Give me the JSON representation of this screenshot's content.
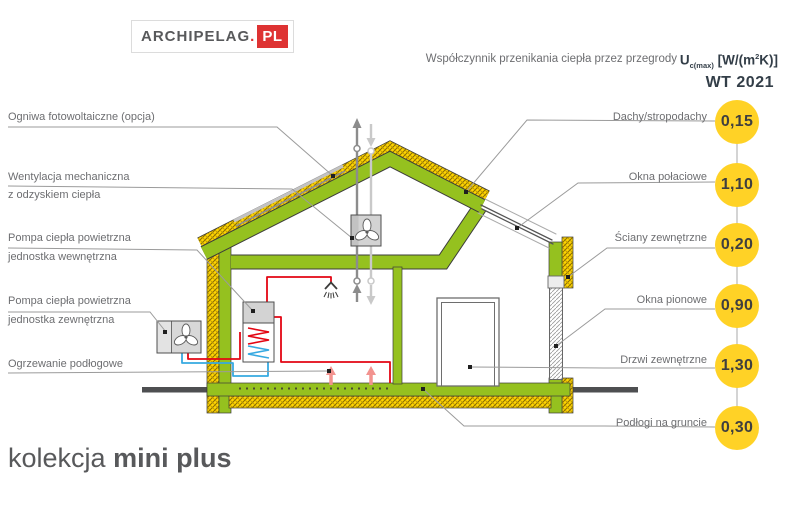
{
  "logo": {
    "brand": "ARCHIPELAG",
    "separator": ".",
    "country": "PL"
  },
  "header": {
    "title": "Współczynnik przenikania ciepła przez przegrody",
    "u_symbol": "U",
    "u_subscript": "c(max)",
    "u_units_open": " [W/(m",
    "u_units_exp": "2",
    "u_units_close": "K)]",
    "standard": "WT 2021"
  },
  "left_labels": [
    {
      "line1": "Ogniwa fotowoltaiczne (opcja)",
      "line2": ""
    },
    {
      "line1": "Wentylacja mechaniczna",
      "line2": "z odzyskiem ciepła"
    },
    {
      "line1": "Pompa ciepła powietrzna",
      "line2": "jednostka wewnętrzna"
    },
    {
      "line1": "Pompa ciepła powietrzna",
      "line2": "jednostka zewnętrzna"
    },
    {
      "line1": "Ogrzewanie podłogowe",
      "line2": ""
    }
  ],
  "right_items": [
    {
      "label": "Dachy/stropodachy",
      "value": "0,15"
    },
    {
      "label": "Okna połaciowe",
      "value": "1,10"
    },
    {
      "label": "Ściany zewnętrzne",
      "value": "0,20"
    },
    {
      "label": "Okna pionowe",
      "value": "0,90"
    },
    {
      "label": "Drzwi zewnętrzne",
      "value": "1,30"
    },
    {
      "label": "Podłogi na gruncie",
      "value": "0,30"
    }
  ],
  "collection": {
    "prefix": "kolekcja",
    "name": "mini plus"
  },
  "colors": {
    "wall_green": "#95C11F",
    "insulation_yellow": "#FFD500",
    "badge_yellow": "#FFD226",
    "pipe_red": "#E30613",
    "pipe_blue": "#36A9E1",
    "logo_red": "#DE3333",
    "text_gray": "#6D6E71"
  }
}
